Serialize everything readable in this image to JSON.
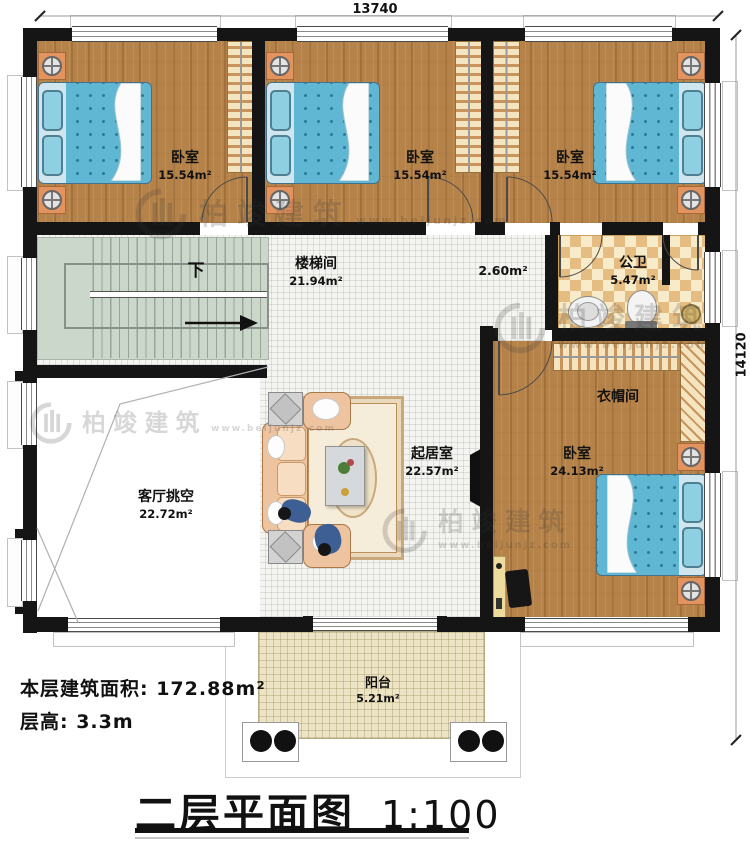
{
  "dimensions": {
    "top": "13740",
    "right": "14120"
  },
  "rooms": {
    "bedroom_tl": {
      "name": "卧室",
      "area": "15.54m²"
    },
    "bedroom_tm": {
      "name": "卧室",
      "area": "15.54m²"
    },
    "bedroom_tr": {
      "name": "卧室",
      "area": "15.54m²"
    },
    "stair_hall": {
      "name": "楼梯间",
      "area": "21.94m²"
    },
    "corridor": {
      "area": "2.60m²"
    },
    "bathroom": {
      "name": "公卫",
      "area": "5.47m²"
    },
    "cloakroom": {
      "name": "衣帽间"
    },
    "master_bedroom": {
      "name": "卧室",
      "area": "24.13m²"
    },
    "living_room": {
      "name": "起居室",
      "area": "22.57m²"
    },
    "living_void": {
      "name": "客厅挑空",
      "area": "22.72m²"
    },
    "balcony": {
      "name": "阳台",
      "area": "5.21m²"
    }
  },
  "stairs": {
    "direction_label": "下"
  },
  "notes": {
    "floor_area": "本层建筑面积: 172.88m²",
    "floor_height": "层高: 3.3m"
  },
  "title_block": {
    "title": "二层平面图",
    "scale": "1:100"
  },
  "watermark": {
    "brand": "柏竣建筑",
    "url": "www.beijunjz.com"
  },
  "colors": {
    "wall": "#151515",
    "wood_floor": "#b5834a",
    "bed": "#5fb7d4",
    "stairs": "#ccd7cb",
    "bath_tile": "#e5bd83",
    "balcony": "#ece4c4",
    "nightstand": "#e2935e"
  }
}
